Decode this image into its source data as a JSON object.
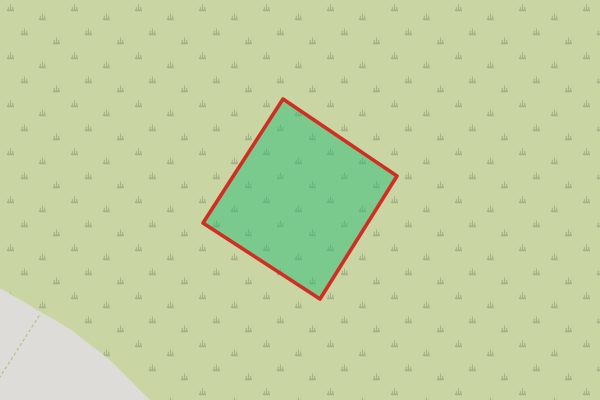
{
  "map": {
    "background_color": "#c9d5a3",
    "scrub": {
      "symbol_color": "#a3ad84",
      "symbol_opacity": "0.9"
    },
    "gray_area": {
      "color": "#dedcd8",
      "points": "0,288 70,329 110,360 150,400 0,400"
    },
    "footpath": {
      "color": "#b9c193",
      "d": "M39,316 L0,377",
      "dash": "2 3.5",
      "width": "1.3"
    },
    "selection": {
      "fill": "rgba(35,190,120,0.48)",
      "stroke": "#d02d23",
      "stroke_width": "3.6",
      "points": "283,99 397,176 320,299 203,223"
    }
  }
}
